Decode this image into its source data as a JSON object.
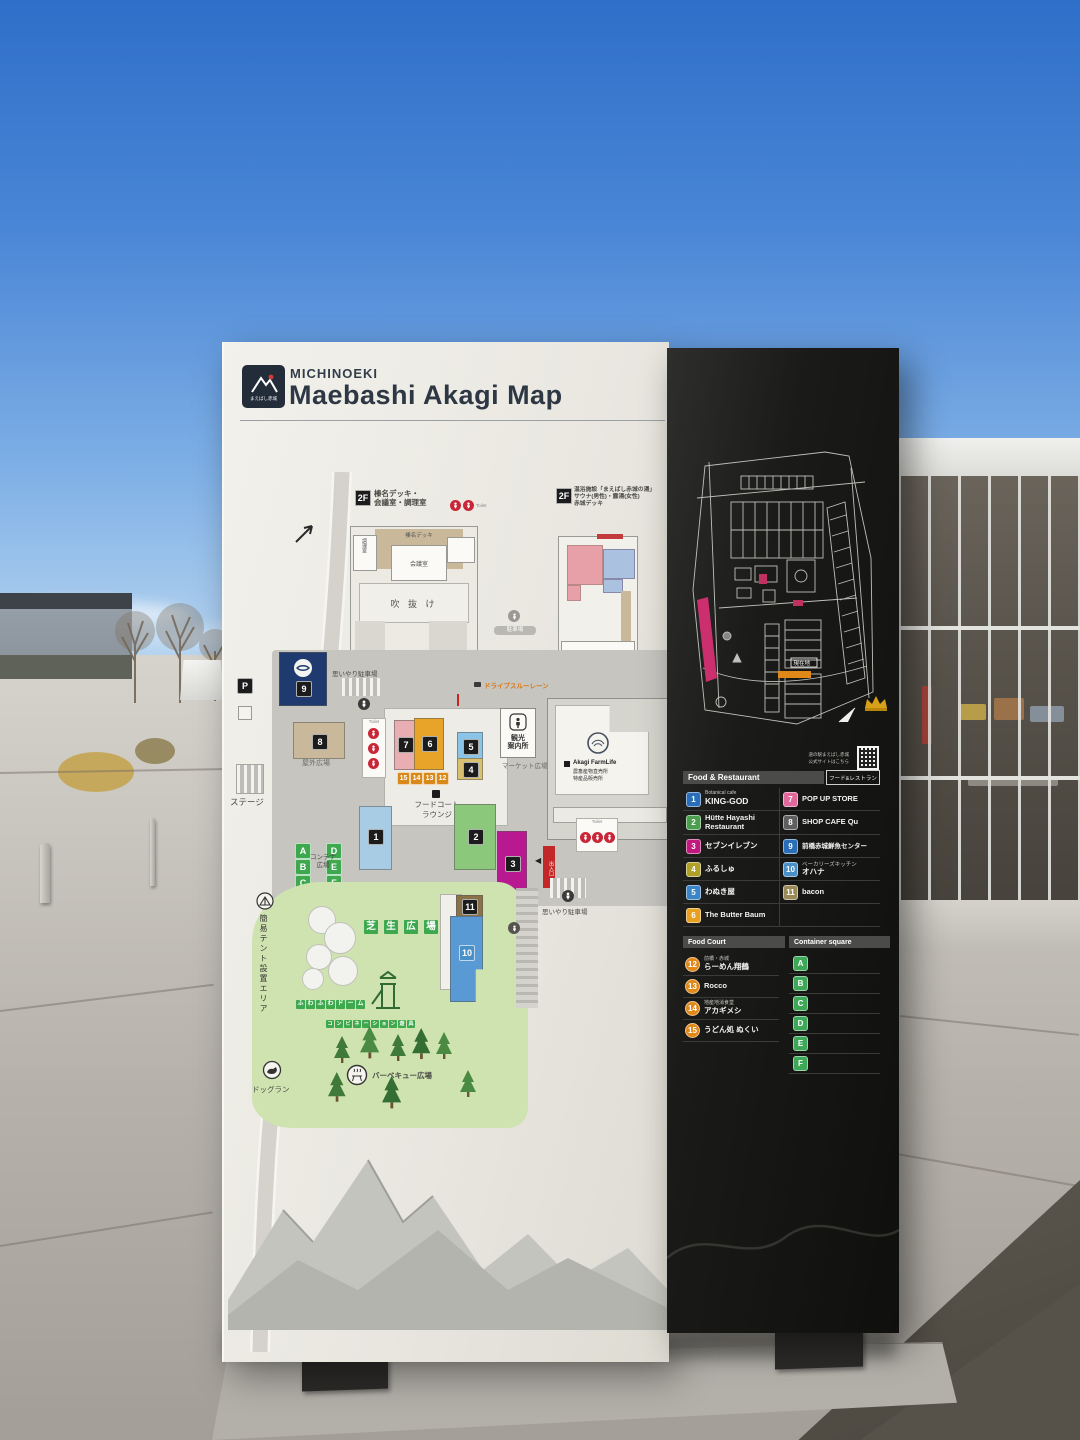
{
  "header": {
    "brand_small": "MICHINOEKI",
    "brand_title": "Maebashi Akagi Map",
    "logo_caption": "まえばし赤城"
  },
  "map": {
    "floor2_left": {
      "badge": "2F",
      "title1": "榛名デッキ・",
      "title2": "会議室・調理室",
      "room_kitchen": "調理室",
      "room_deck": "榛名デッキ",
      "room_meeting": "会議室",
      "room_atrium": "吹 抜 け"
    },
    "floor2_right": {
      "badge": "2F",
      "title1": "温浴施設「まえばし赤城の湯」",
      "title2": "サウナ(男性)・露湯(女性)",
      "title3": "赤城デッキ"
    },
    "labels": {
      "sidewalk": "歩道",
      "stage": "ステージ",
      "parking_badge": "P",
      "toilet": "Toilet",
      "parking_pill": "駐車場",
      "accessible_parking": "思いやり駐車場",
      "drive_through": "ドライブスルーレーン",
      "outdoor_plaza": "屋外広場",
      "market_plaza": "マーケット広場",
      "food_court1": "フードコート",
      "food_court2": "ラウンジ",
      "info1": "観光",
      "info2": "案内所",
      "farm_en": "Akagi FarmLife",
      "farm_jp1": "農畜産物直売所",
      "farm_jp2": "特産品販売所",
      "container_plaza1": "コンテナ",
      "container_plaza2": "広場",
      "lawn": "芝生広場",
      "fuwafuwa": "ふわふわドーム",
      "playground": "コンビネーション遊具",
      "bbq": "バーベキュー広場",
      "dog_run": "ドッグラン",
      "tent_area": "簡易テント設置エリア",
      "entrance_sign": "出入口",
      "arrow_left": "◀"
    },
    "markers": {
      "n1": "1",
      "n2": "2",
      "n3": "3",
      "n4": "4",
      "n5": "5",
      "n6": "6",
      "n7": "7",
      "n8": "8",
      "n9": "9",
      "n10": "10",
      "n11": "11",
      "stalls": [
        "15",
        "14",
        "13",
        "12"
      ],
      "containers": [
        "A",
        "B",
        "C",
        "D",
        "E",
        "F"
      ]
    }
  },
  "parking_map": {
    "you_are_here": "現在地",
    "note1": "道の駅まえばし赤城",
    "note2": "公式サイトはこちら"
  },
  "panel": {
    "food_restaurant": {
      "title_en": "Food & Restaurant",
      "title_jp": "フード&レストラン",
      "items_left": [
        {
          "num": "1",
          "color": "#2a6db8",
          "sub": "Botanical cafe",
          "label": "KING-GOD"
        },
        {
          "num": "2",
          "color": "#4a9e4e",
          "label": "Hütte Hayashi",
          "label2": "Restaurant"
        },
        {
          "num": "3",
          "color": "#c0187e",
          "label": "セブンイレブン"
        },
        {
          "num": "4",
          "color": "#b0a028",
          "label": "ふるしゅ"
        },
        {
          "num": "5",
          "color": "#3a85c8",
          "label": "わぬき屋"
        },
        {
          "num": "6",
          "color": "#e8a020",
          "label": "The Butter Baum"
        }
      ],
      "items_right": [
        {
          "num": "7",
          "color": "#e0689a",
          "label": "POP UP STORE"
        },
        {
          "num": "8",
          "color": "#5f5f5f",
          "label": "SHOP CAFE Qu"
        },
        {
          "num": "9",
          "color": "#2a6db8",
          "label": "前橋赤城鮮魚センター"
        },
        {
          "num": "10",
          "color": "#4a90c8",
          "sub": "ベーカリーズキッチン",
          "label": "オハナ"
        },
        {
          "num": "11",
          "color": "#9a8a58",
          "label": "bacon"
        }
      ]
    },
    "food_court": {
      "title": "Food Court",
      "marker_color": "#e08818",
      "items": [
        {
          "num": "12",
          "sub": "前橋・赤城",
          "label": "らーめん翔鶴"
        },
        {
          "num": "13",
          "sub": "",
          "label": "Rocco"
        },
        {
          "num": "14",
          "sub": "地産地消食堂",
          "label": "アカギメシ"
        },
        {
          "num": "15",
          "sub": "",
          "label": "うどん処 ぬくい"
        }
      ]
    },
    "container_square": {
      "title": "Container square",
      "marker_color": "#3da858",
      "letters": [
        "A",
        "B",
        "C",
        "D",
        "E",
        "F"
      ]
    }
  },
  "colors": {
    "board_dark": "#161614",
    "board_light": "#e9e7e0",
    "accent_red": "#c92638",
    "lawn_green": "#cfe3b0",
    "plaza_gray": "#c6c5c0",
    "navy": "#1e3a6e",
    "crown_gold": "#d8a018"
  }
}
